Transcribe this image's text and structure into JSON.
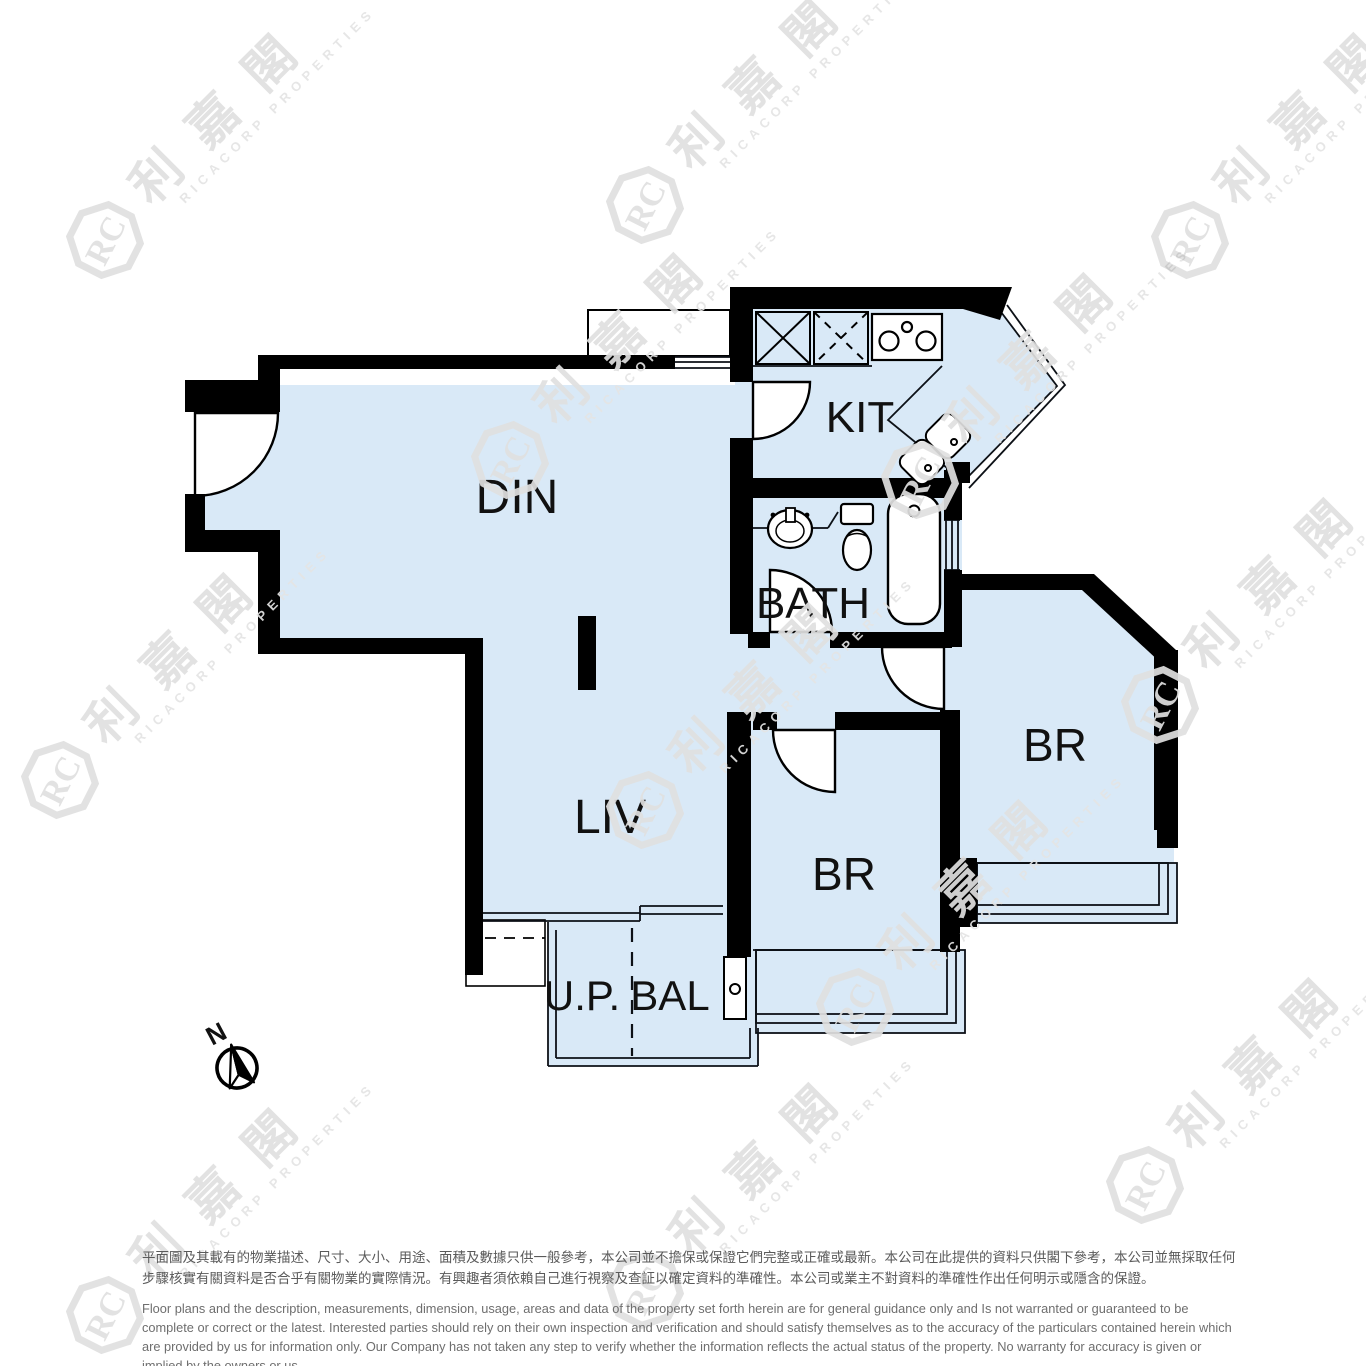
{
  "floorplan": {
    "rooms": {
      "din": {
        "label": "DIN"
      },
      "liv": {
        "label": "LIV"
      },
      "kit": {
        "label": "KIT"
      },
      "bath": {
        "label": "BATH"
      },
      "br_right": {
        "label": "BR"
      },
      "br_left": {
        "label": "BR"
      },
      "up": {
        "label": "U.P."
      },
      "bal": {
        "label": "BAL"
      }
    },
    "compass": {
      "north_label": "N"
    },
    "colors": {
      "floor_fill": "#d9e9f7",
      "wall": "#000000",
      "line": "#0d1117"
    },
    "icons": [
      "stove-icon",
      "kitchen-sink-icon",
      "kitchen-cabinet-icon",
      "wash-basin-icon",
      "toilet-icon",
      "bathtub-icon",
      "compass-icon",
      "door-arc"
    ]
  },
  "watermark": {
    "cjk": "利嘉閣",
    "latin": "RICACORP PROPERTIES",
    "logo_text": "RC"
  },
  "disclaimer": {
    "zh": "平面圖及其載有的物業描述、尺寸、大小、用途、面積及數據只供一般參考，本公司並不擔保或保證它們完整或正確或最新。本公司在此提供的資料只供閣下參考，本公司並無採取任何步驟核實有關資料是否合乎有關物業的實際情況。有興趣者須依賴自己進行視察及查証以確定資料的準確性。本公司或業主不對資料的準確性作出任何明示或隱含的保證。",
    "en": "Floor plans and the description, measurements, dimension, usage, areas and data of the property set forth herein are for general guidance only and Is not warranted or guaranteed to be complete or correct or the latest.  Interested parties should rely on their own inspection and verification and should satisfy themselves as to the accuracy of the particulars contained herein which are provided by us for information only.  Our Company has not taken any step to verify whether the information reflects the actual status of the property.  No warranty for accuracy is given or implied by the owners or us."
  }
}
